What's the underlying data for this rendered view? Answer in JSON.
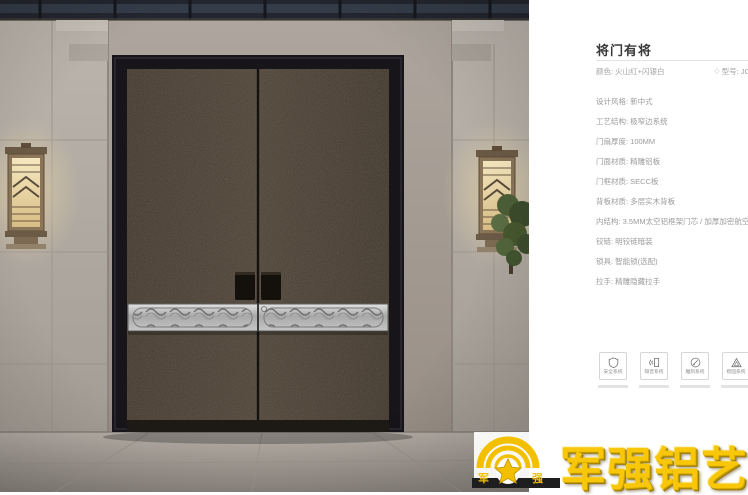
{
  "product": {
    "title": "将门有将",
    "color": "颜色: 火山红+闪银白",
    "model": "型号: JC",
    "specs": [
      "设计风格: 新中式",
      "工艺结构: 极窄边系统",
      "门扇厚度: 100MM",
      "门面材质: 精雕铝板",
      "门框材质: SECC板",
      "背板材质: 多层实木背板",
      "内结构: 3.5MM太空铝框架门芯 / 加厚加密航空铝边框",
      "铰链: 明铰链暗装",
      "锁具: 智能锁(选配)",
      "拉手: 精雕隐藏拉手"
    ],
    "features": [
      {
        "label": "安全系统",
        "icon": "shield-icon"
      },
      {
        "label": "隔音系统",
        "icon": "soundproof-icon"
      },
      {
        "label": "雕刻系统",
        "icon": "carving-icon"
      },
      {
        "label": "稳固系统",
        "icon": "stability-icon"
      }
    ],
    "model_icon": "◇"
  },
  "brand": {
    "name": "军强铝艺",
    "emblem_left": "军",
    "emblem_right": "强",
    "gold": "#f6c70a"
  },
  "scene": {
    "ceiling_color": "#23262e",
    "wall_color": "#b5aea6",
    "door_frame_color": "#17151a",
    "door_leaf_color": "#473c31",
    "silver_band_color": "#c9c9c9",
    "floor_color": "#a8a29a"
  }
}
